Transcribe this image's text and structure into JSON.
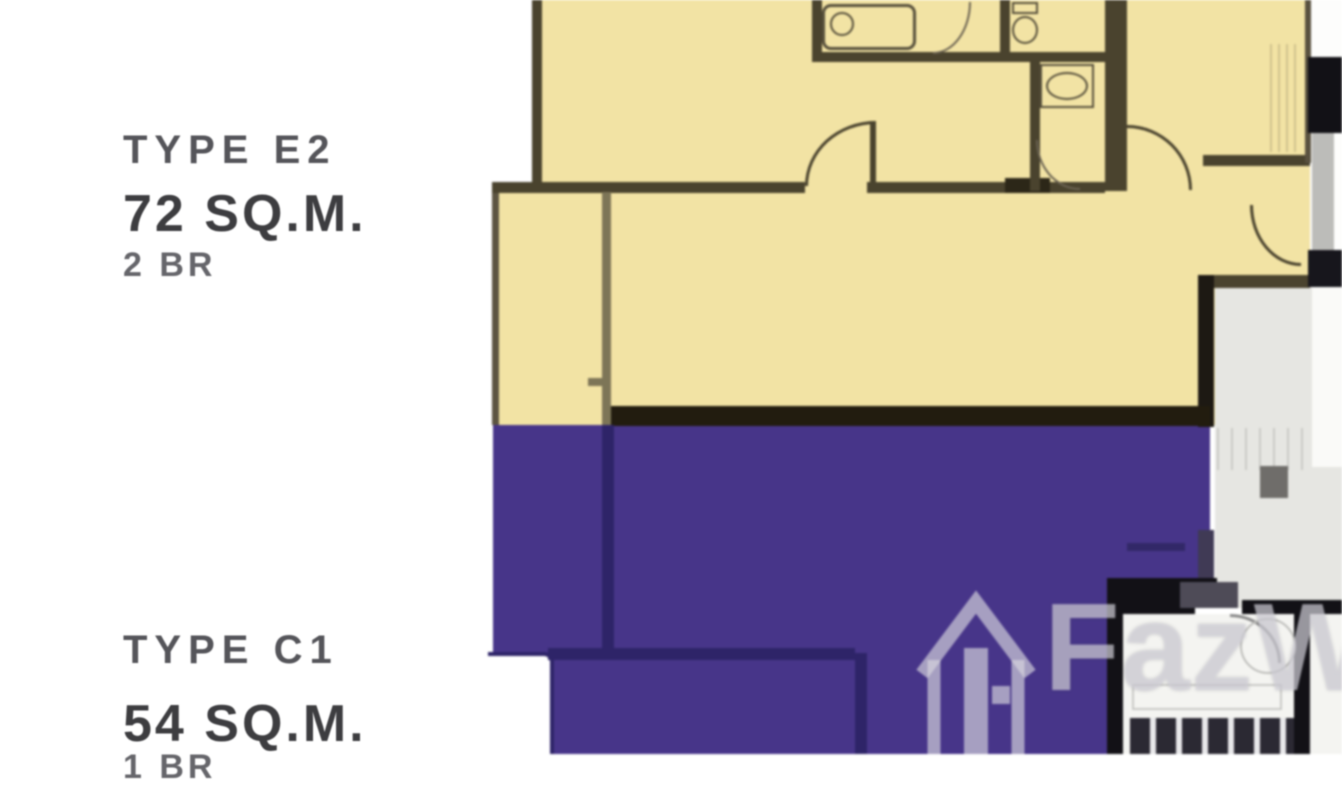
{
  "image": {
    "kind": "condo-floor-plan"
  },
  "units": [
    {
      "label": "TYPE E2",
      "area": "72 SQ.M.",
      "bedrooms": "2 BR",
      "fill": "#f2e3a4"
    },
    {
      "label": "TYPE C1",
      "area": "54 SQ.M.",
      "bedrooms": "1 BR",
      "fill": "#473589"
    }
  ],
  "watermark": {
    "text": "FazWaz",
    "icon": "house-logo-icon"
  },
  "colors": {
    "cream": "#f2e3a4",
    "cream-wall": "#4a432e",
    "cream-wall-light": "#7d7557",
    "purple": "#473589",
    "purple-wall": "#2e2468",
    "black-wall": "#121116",
    "corridor": "#e6e6e2",
    "white-room": "#f4f4f1",
    "fixture": "#57503c",
    "label-strong": "#3d3d40",
    "label-mid": "#55555a",
    "label-light": "#66666b",
    "watermark": "rgba(216,214,222,0.66)"
  }
}
